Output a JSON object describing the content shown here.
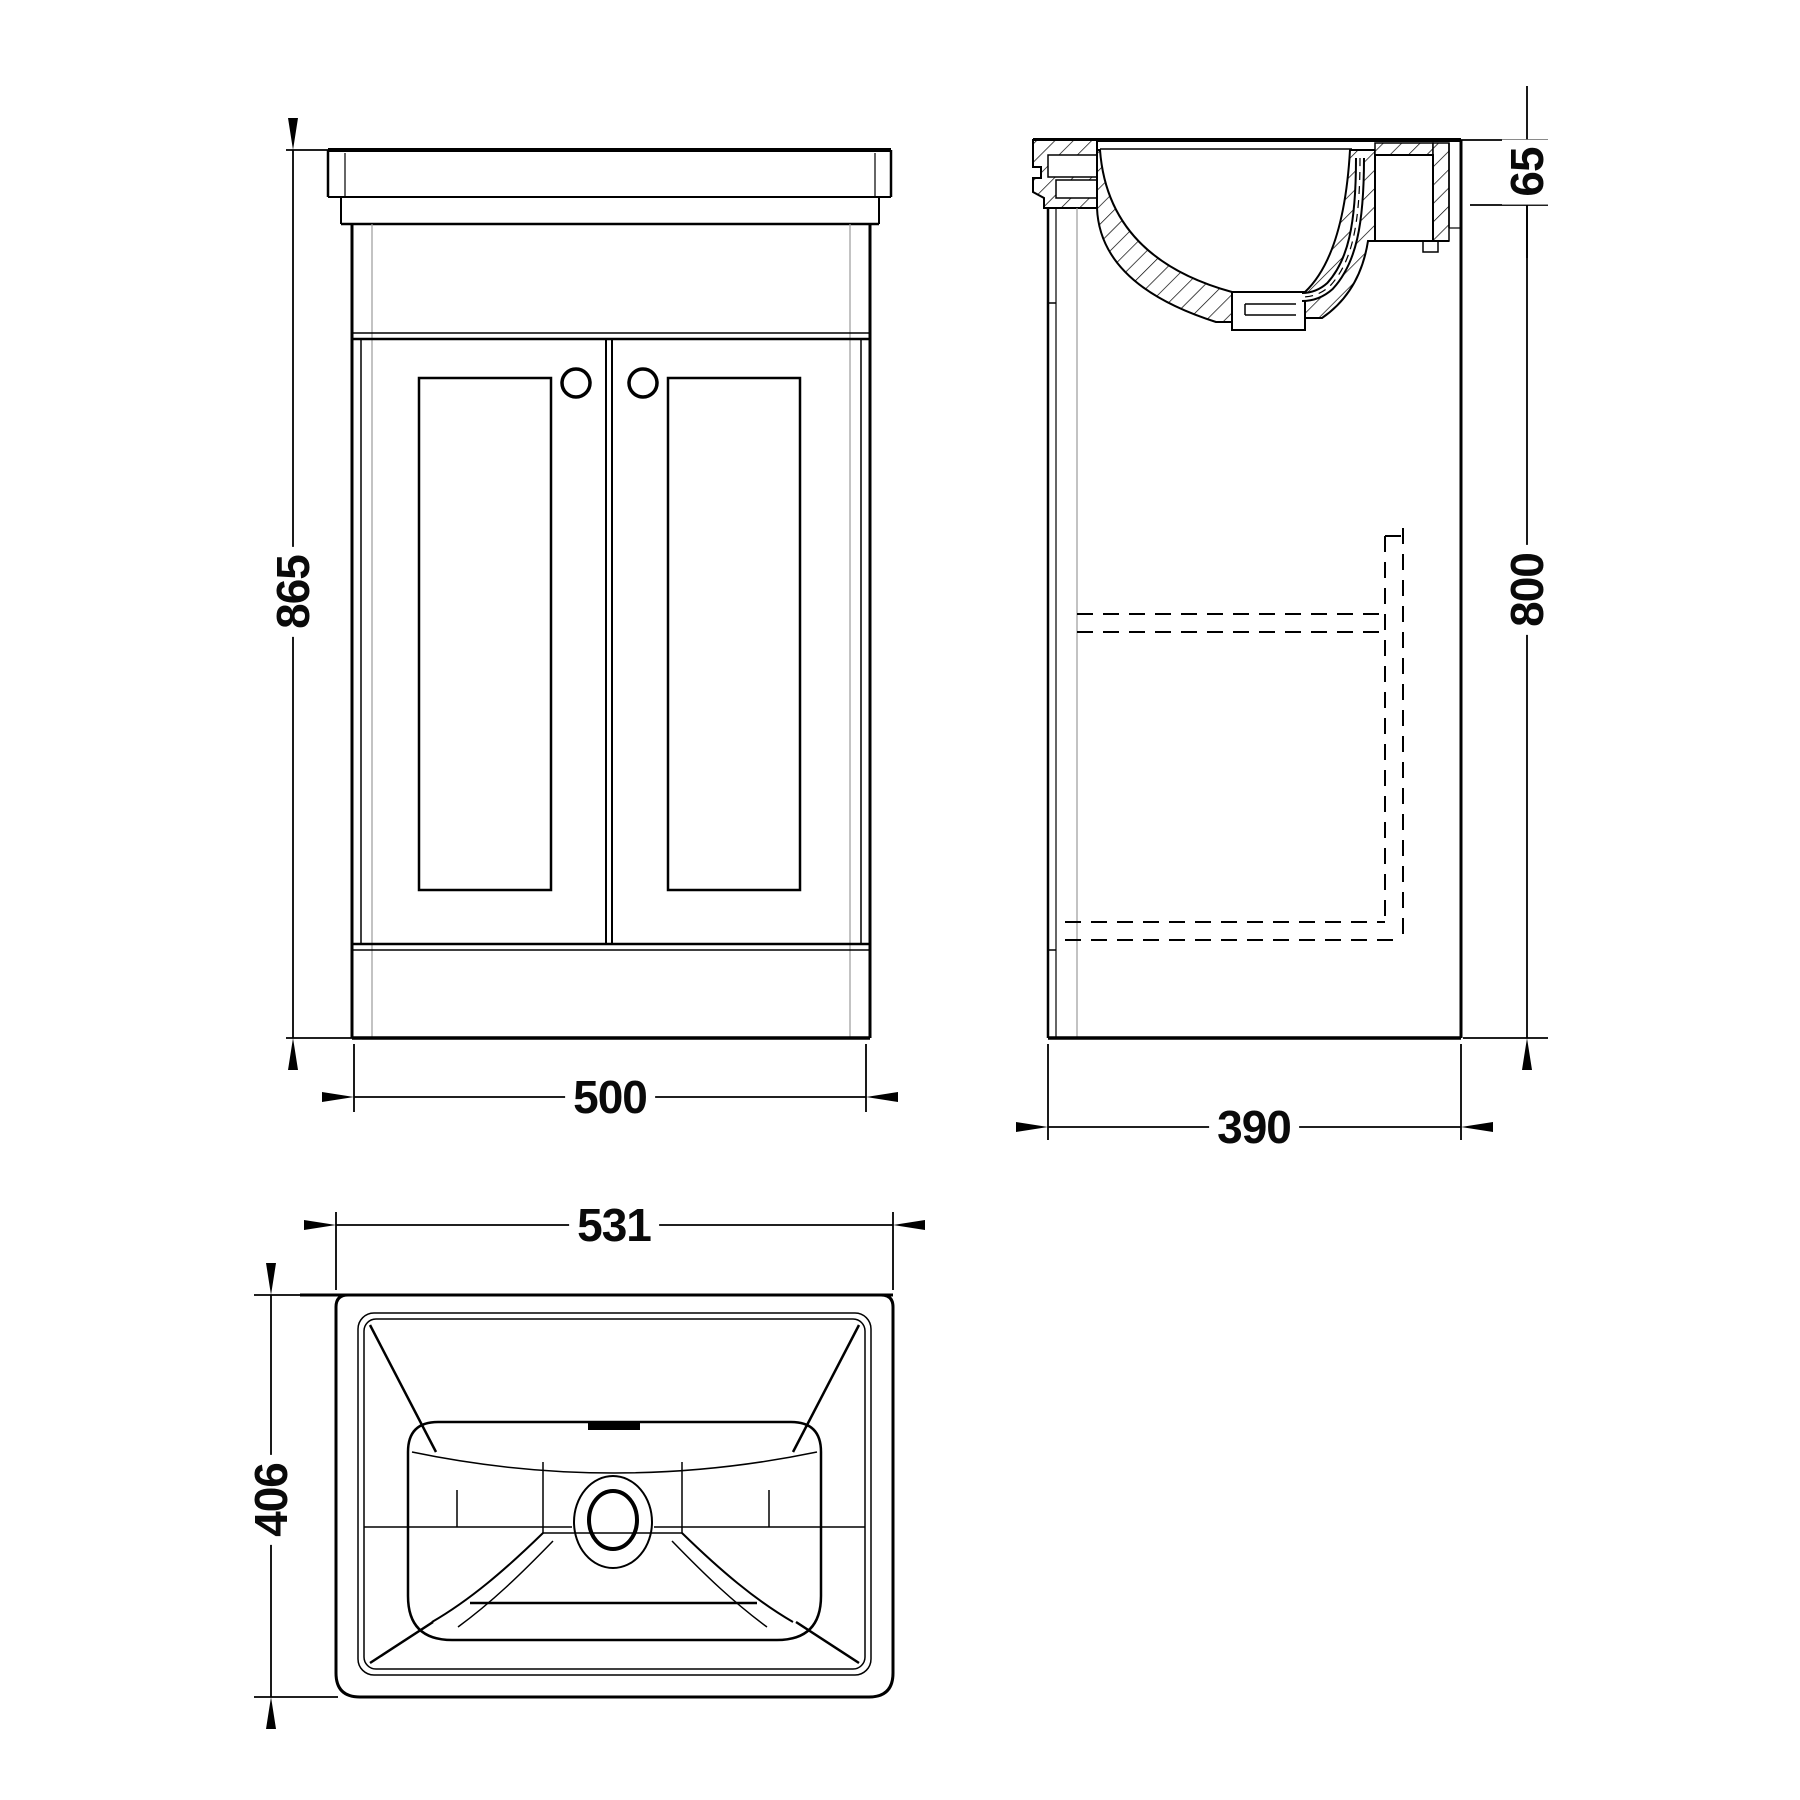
{
  "drawing": {
    "type": "technical-orthographic-drawing",
    "subject": "bathroom vanity unit with inset basin",
    "colors": {
      "line": "#000000",
      "secondary_line": "#9b9b9b",
      "background": "#ffffff"
    },
    "views": [
      {
        "id": "front",
        "name": "front elevation",
        "dimension_labels": [
          "865",
          "500"
        ]
      },
      {
        "id": "side",
        "name": "side section",
        "dimension_labels": [
          "65",
          "800",
          "390"
        ]
      },
      {
        "id": "plan",
        "name": "basin plan",
        "dimension_labels": [
          "531",
          "406"
        ]
      }
    ],
    "labels": {
      "front_height": "865",
      "front_width": "500",
      "side_basin_lip": "65",
      "side_height": "800",
      "side_depth": "390",
      "plan_width": "531",
      "plan_depth": "406"
    }
  }
}
